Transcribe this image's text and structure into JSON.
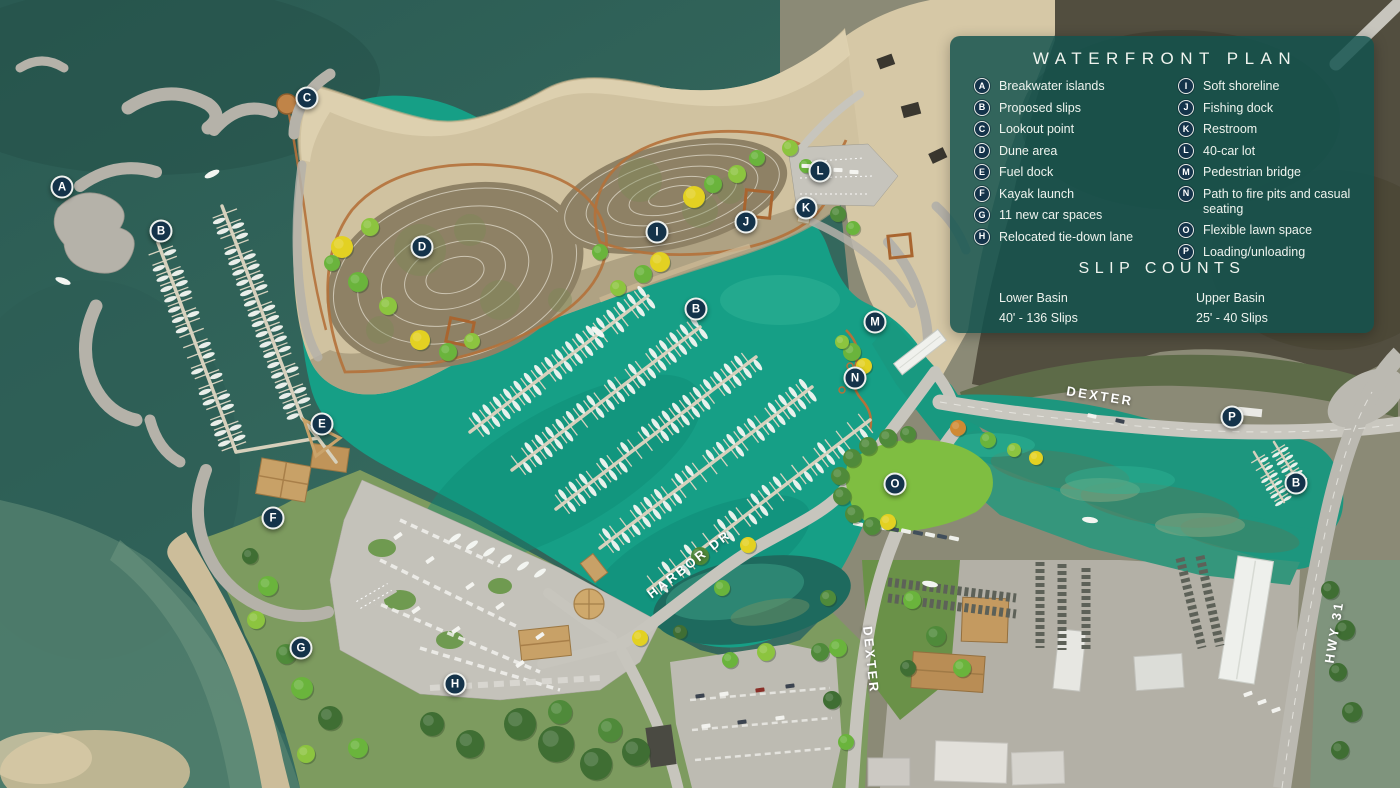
{
  "legend": {
    "title": "WATERFRONT PLAN",
    "items_left": [
      {
        "key": "A",
        "label": "Breakwater islands"
      },
      {
        "key": "B",
        "label": "Proposed slips"
      },
      {
        "key": "C",
        "label": "Lookout point"
      },
      {
        "key": "D",
        "label": "Dune area"
      },
      {
        "key": "E",
        "label": "Fuel dock"
      },
      {
        "key": "F",
        "label": "Kayak launch"
      },
      {
        "key": "G",
        "label": "11 new car spaces"
      },
      {
        "key": "H",
        "label": "Relocated tie-down lane"
      }
    ],
    "items_right": [
      {
        "key": "I",
        "label": "Soft shoreline"
      },
      {
        "key": "J",
        "label": "Fishing dock"
      },
      {
        "key": "K",
        "label": "Restroom"
      },
      {
        "key": "L",
        "label": "40-car lot"
      },
      {
        "key": "M",
        "label": "Pedestrian bridge"
      },
      {
        "key": "N",
        "label": "Path to fire pits and casual seating"
      },
      {
        "key": "O",
        "label": "Flexible lawn space"
      },
      {
        "key": "P",
        "label": "Loading/unloading"
      }
    ],
    "slip_counts": {
      "heading": "SLIP COUNTS",
      "columns": [
        {
          "name": "Lower Basin",
          "value": "40' - 136 Slips"
        },
        {
          "name": "Upper Basin",
          "value": "25' - 40 Slips"
        }
      ]
    }
  },
  "markers": [
    {
      "letter": "A",
      "label": "Breakwater islands",
      "x": 62,
      "y": 187
    },
    {
      "letter": "B",
      "label": "Proposed slips",
      "x": 161,
      "y": 231
    },
    {
      "letter": "C",
      "label": "Lookout point",
      "x": 307,
      "y": 98
    },
    {
      "letter": "D",
      "label": "Dune area",
      "x": 422,
      "y": 247
    },
    {
      "letter": "E",
      "label": "Fuel dock",
      "x": 322,
      "y": 424
    },
    {
      "letter": "F",
      "label": "Kayak launch",
      "x": 273,
      "y": 518
    },
    {
      "letter": "G",
      "label": "11 new car spaces",
      "x": 301,
      "y": 648
    },
    {
      "letter": "H",
      "label": "Relocated tie-down lane",
      "x": 455,
      "y": 684
    },
    {
      "letter": "I",
      "label": "Soft shoreline",
      "x": 657,
      "y": 232
    },
    {
      "letter": "J",
      "label": "Fishing dock",
      "x": 746,
      "y": 222
    },
    {
      "letter": "K",
      "label": "Restroom",
      "x": 806,
      "y": 208
    },
    {
      "letter": "L",
      "label": "40-car lot",
      "x": 820,
      "y": 171
    },
    {
      "letter": "B",
      "label": "Proposed slips",
      "x": 696,
      "y": 309
    },
    {
      "letter": "M",
      "label": "Pedestrian bridge",
      "x": 875,
      "y": 322
    },
    {
      "letter": "N",
      "label": "Path to fire pits and casual seating",
      "x": 855,
      "y": 378
    },
    {
      "letter": "O",
      "label": "Flexible lawn space",
      "x": 895,
      "y": 484
    },
    {
      "letter": "P",
      "label": "Loading/unloading",
      "x": 1232,
      "y": 417
    },
    {
      "letter": "B",
      "label": "Proposed slips",
      "x": 1296,
      "y": 483
    }
  ],
  "road_labels": [
    {
      "text": "DEXTER",
      "x": 1100,
      "y": 396,
      "rotation": 9
    },
    {
      "text": "DEXTER",
      "x": 871,
      "y": 660,
      "rotation": 84
    },
    {
      "text": "HARBOR DR",
      "x": 689,
      "y": 564,
      "rotation": -38
    },
    {
      "text": "HWY 31",
      "x": 1334,
      "y": 632,
      "rotation": -81
    }
  ],
  "colors": {
    "panel": "rgba(18,82,78,0.84)",
    "marker_fill": "#14334a",
    "marker_ring": "#eef1ee",
    "water_deep": "#35695e",
    "water_basin": "#169f86",
    "water_upper": "#1d967e",
    "sand": "#d5c7a5",
    "grass": "#7d9b5f",
    "road": "#c7c5bd",
    "path_orange": "#b4713a"
  }
}
